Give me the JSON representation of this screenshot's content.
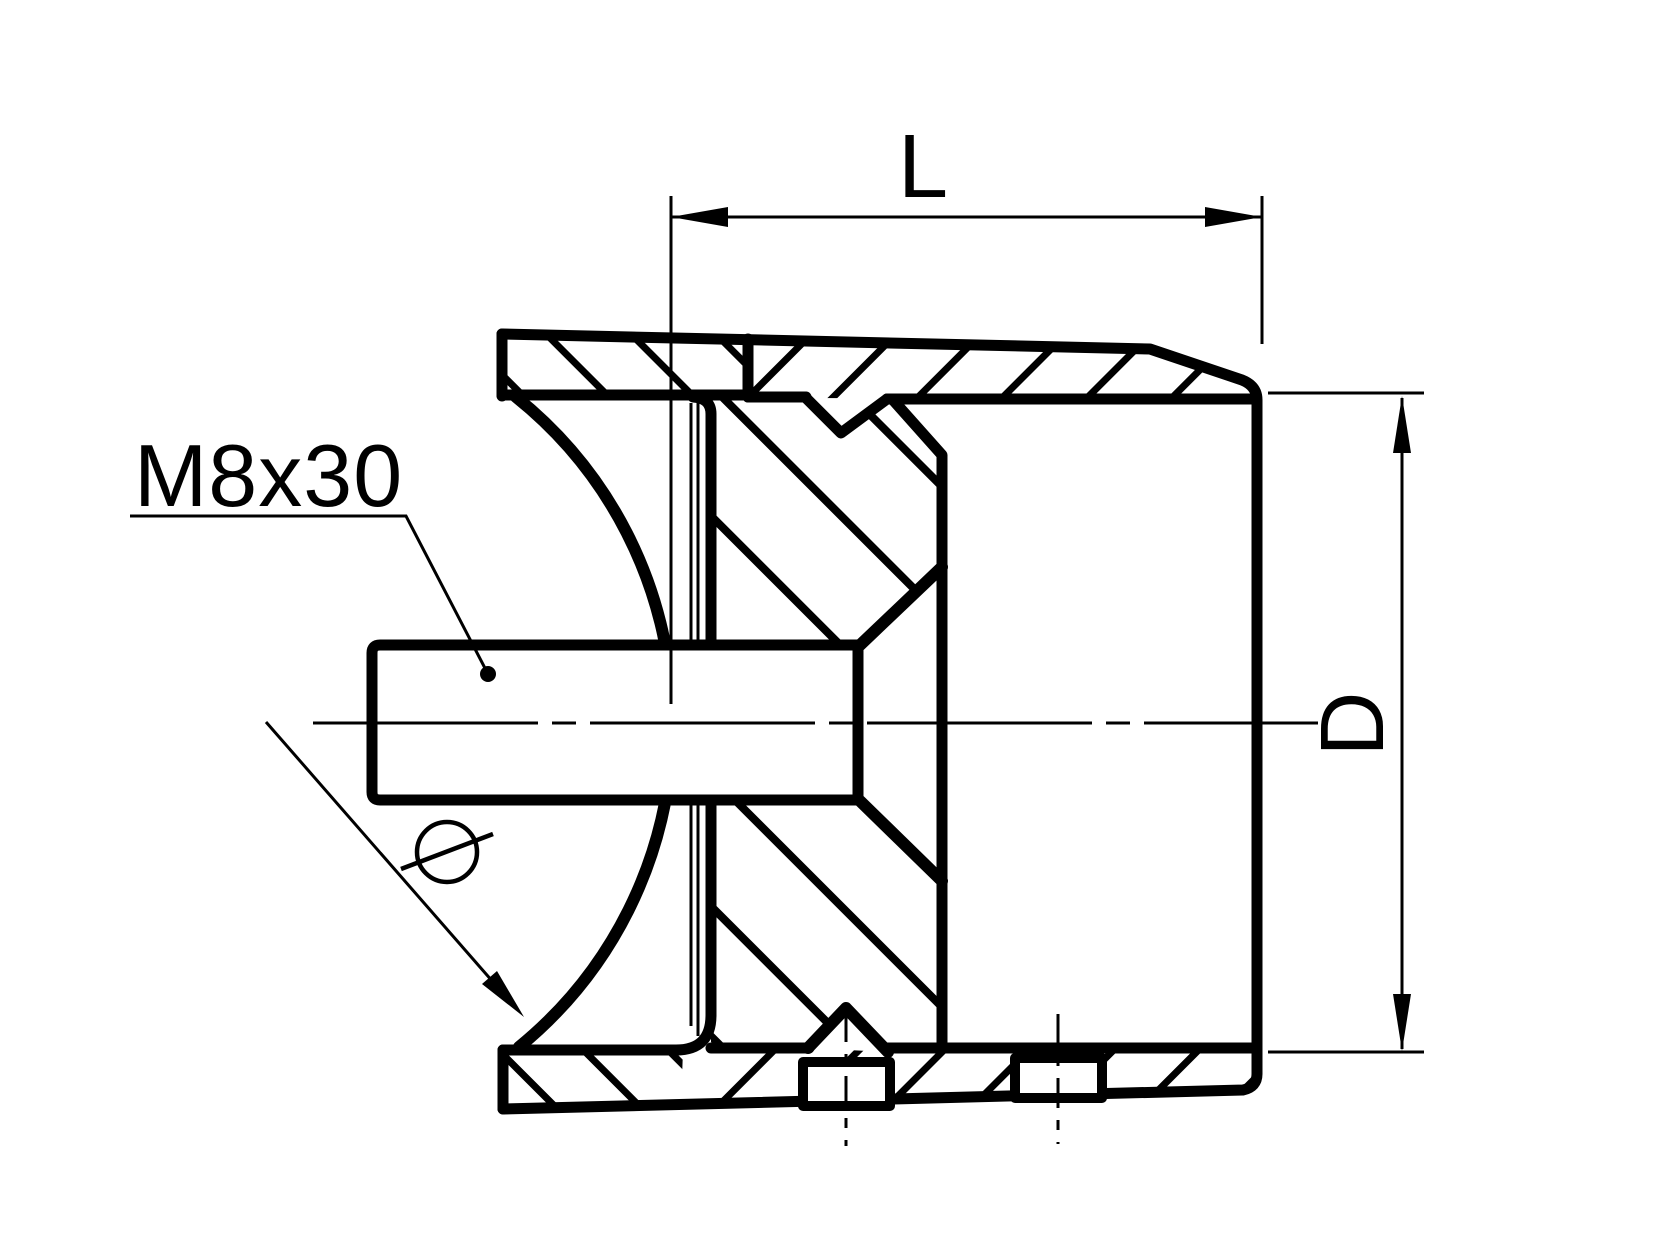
{
  "drawing": {
    "type": "technical-section-drawing",
    "description": "Cross-section of a tube saddle adapter with pressed-in threaded stud",
    "background_color": "#ffffff",
    "line_color": "#000000",
    "labels": {
      "length_dimension": "L",
      "diameter_dimension": "D",
      "thread_spec": "M8x30",
      "diameter_symbol": "Ø"
    }
  }
}
